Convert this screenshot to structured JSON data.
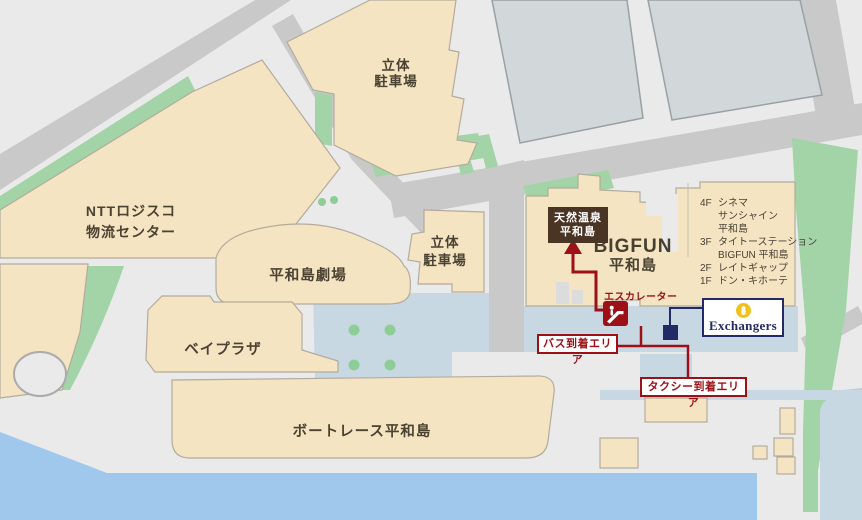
{
  "colors": {
    "accent_red": "#9c1016",
    "navy": "#232a67",
    "gold": "#f2c21c",
    "brown_box": "#4a3423",
    "building_tan": "#f4e4c1",
    "green": "#a3d4a7",
    "water": "#a0c8ec",
    "plaza_blue": "#c7d8e3"
  },
  "map": {
    "labels": {
      "ntt": [
        "NTTロジスコ",
        "物流センター"
      ],
      "parking_top": [
        "立体",
        "駐車場"
      ],
      "parking_mid": [
        "立体",
        "駐車場"
      ],
      "theater": "平和島劇場",
      "bay_plaza": "ベイプラザ",
      "boat_race": "ボートレース平和島",
      "bigfun": [
        "BIGFUN",
        "平和島"
      ]
    },
    "onsen_box": [
      "天然温泉",
      "平和島"
    ],
    "escalator": "エスカレーター",
    "bus_area": "バス到着エリア",
    "taxi_area": "タクシー到着エリア",
    "exchangers": "Exchangers",
    "floor_list": [
      {
        "f": "4F",
        "t": "シネマ"
      },
      {
        "f": "",
        "t": "サンシャイン"
      },
      {
        "f": "",
        "t": "平和島"
      },
      {
        "f": "3F",
        "t": "タイトーステーション"
      },
      {
        "f": "",
        "t": "BIGFUN 平和島"
      },
      {
        "f": "2F",
        "t": "レイトギャップ"
      },
      {
        "f": "1F",
        "t": "ドン・キホーテ"
      }
    ]
  }
}
